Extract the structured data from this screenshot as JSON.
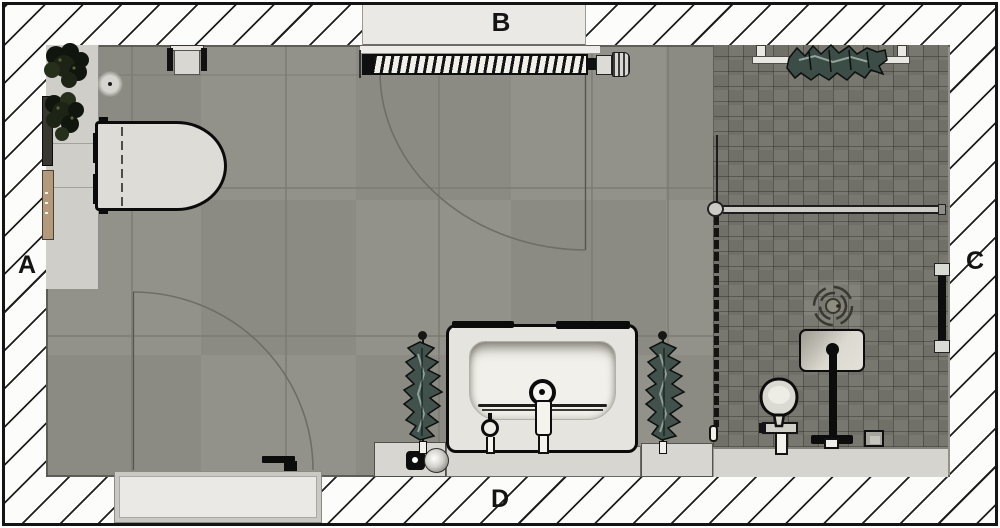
{
  "title": "Bathroom floor plan (top view)",
  "labels": {
    "left": "A",
    "top": "B",
    "right": "C",
    "bottom": "D"
  },
  "colors": {
    "frame": "#141414",
    "hatch-line": "#1e1e1e",
    "wall-bg": "#fcfcfb",
    "floor": "#8f8e86",
    "grout": "#7b7a73",
    "mosaic": "#74736b",
    "counter": "#d7d6d1",
    "fixture-light": "#e6e5e0",
    "outline": "#0d0d0d",
    "towel": "#41514b",
    "towel-highlight": "#8ea199",
    "plant": "#141a12",
    "wood": "#b39a7d",
    "arc": "#6e6d66"
  },
  "fixtures": [
    "toilet",
    "toilet-paper-holder",
    "plants",
    "floor-drain",
    "wall-shelf-dark",
    "wall-shelf-wood",
    "window-with-label-b",
    "radiator",
    "door-swing-arc",
    "entry-door",
    "door-handle",
    "washbasin",
    "basin-drain",
    "faucet",
    "towel-ring",
    "towel-rail-left",
    "towel-rail-right",
    "soap-dispenser",
    "vanity-counter",
    "shower-bench",
    "glass-partition",
    "glass-door-bar",
    "towel-rail-top",
    "grab-bar-right-wall",
    "rain-shower-head",
    "shower-niche",
    "shower-column",
    "hand-shower",
    "shower-drain"
  ]
}
